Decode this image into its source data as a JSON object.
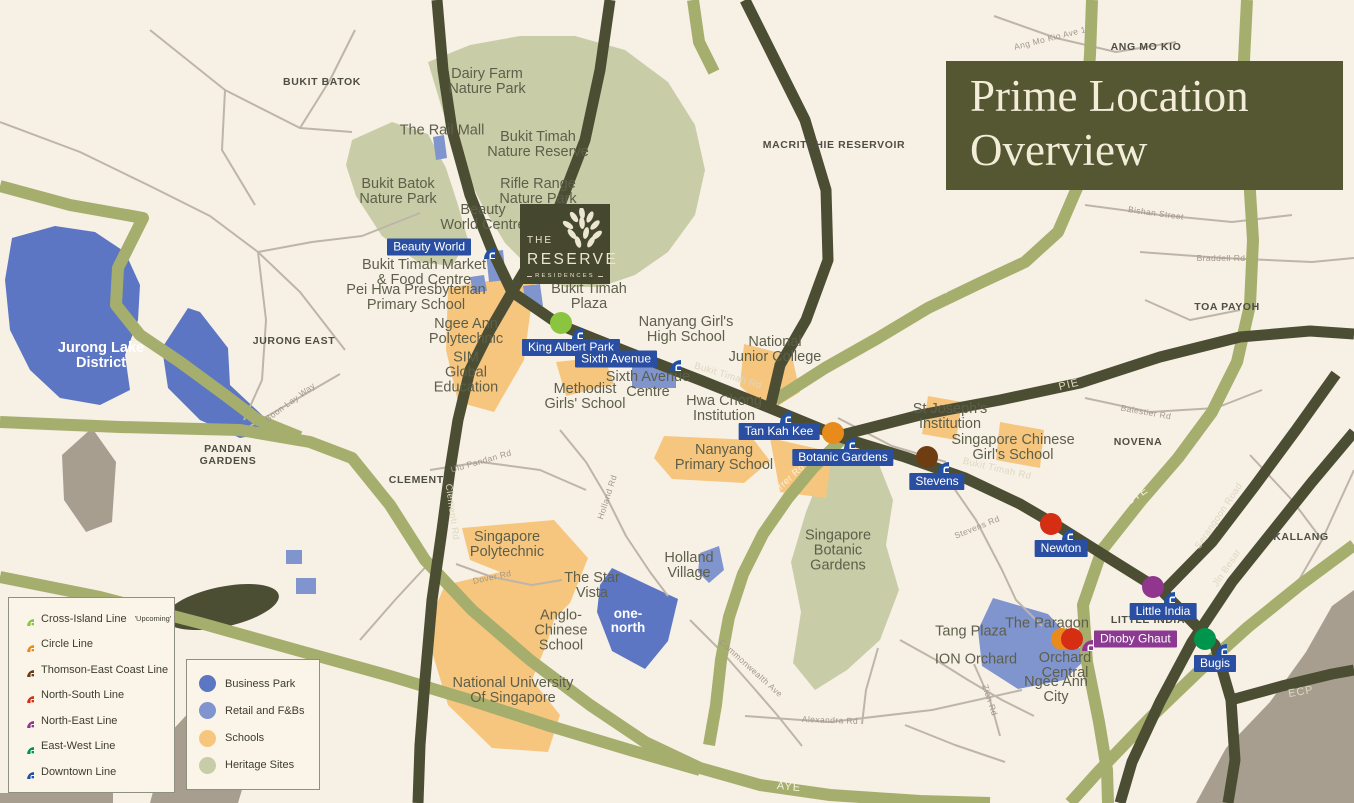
{
  "title": {
    "line1": "Prime Location",
    "line2": "Overview"
  },
  "logo": {
    "the": "THE",
    "name": "RESERVE",
    "sub": "RESIDENCES"
  },
  "legend_lines": [
    {
      "label": "Cross-Island Line",
      "note": "'Upcoming'",
      "color": "#8bc540"
    },
    {
      "label": "Circle Line",
      "color": "#e98a1d"
    },
    {
      "label": "Thomson-East Coast Line",
      "color": "#6e3d12"
    },
    {
      "label": "North-South Line",
      "color": "#d52e13"
    },
    {
      "label": "North-East Line",
      "color": "#91368e"
    },
    {
      "label": "East-West Line",
      "color": "#00954d"
    },
    {
      "label": "Downtown Line",
      "color": "#2150a5"
    }
  ],
  "legend_areas": [
    {
      "label": "Business Park",
      "color": "#5c76c3"
    },
    {
      "label": "Retail and F&Bs",
      "color": "#8094ce"
    },
    {
      "label": "Schools",
      "color": "#f7c67e"
    },
    {
      "label": "Heritage Sites",
      "color": "#c9cda7"
    }
  ],
  "stations": [
    {
      "name": "Beauty World"
    },
    {
      "name": "King Albert Park"
    },
    {
      "name": "Sixth Avenue"
    },
    {
      "name": "Tan Kah Kee"
    },
    {
      "name": "Botanic Gardens"
    },
    {
      "name": "Stevens"
    },
    {
      "name": "Newton"
    },
    {
      "name": "Little India"
    },
    {
      "name": "Dhoby Ghaut"
    },
    {
      "name": "Bugis"
    }
  ],
  "places": [
    {
      "t": "Dairy Farm\nNature Park"
    },
    {
      "t": "The Rail Mall"
    },
    {
      "t": "Bukit Timah\nNature Reserve"
    },
    {
      "t": "Bukit Batok\nNature Park"
    },
    {
      "t": "Rifle Range\nNature Park"
    },
    {
      "t": "Beauty\nWorld Centre"
    },
    {
      "t": "Bukit Timah Market\n& Food Centre"
    },
    {
      "t": "Pei Hwa Presbyterian\nPrimary School"
    },
    {
      "t": "Ngee Ann\nPolytechnic"
    },
    {
      "t": "SIM\nGlobal\nEducation"
    },
    {
      "t": "Bukit Timah\nPlaza"
    },
    {
      "t": "Nanyang Girl's\nHigh School"
    },
    {
      "t": "National\nJunior College"
    },
    {
      "t": "Sixth Avenue\nCentre"
    },
    {
      "t": "Methodist\nGirls' School"
    },
    {
      "t": "Hwa Chong\nInstitution"
    },
    {
      "t": "Nanyang\nPrimary School"
    },
    {
      "t": "St Joseph's\nInstitution"
    },
    {
      "t": "Singapore Chinese\nGirl's School"
    },
    {
      "t": "Singapore\nBotanic\nGardens"
    },
    {
      "t": "Holland\nVillage"
    },
    {
      "t": "The Star\nVista"
    },
    {
      "t": "Anglo-\nChinese\nSchool"
    },
    {
      "t": "one-\nnorth"
    },
    {
      "t": "Singapore\nPolytechnic"
    },
    {
      "t": "National University\nOf Singapore"
    },
    {
      "t": "Jurong Lake\nDistrict"
    },
    {
      "t": "Tang Plaza"
    },
    {
      "t": "The Paragon"
    },
    {
      "t": "ION Orchard"
    },
    {
      "t": "Orchard\nCentral"
    },
    {
      "t": "Ngee Ann\nCity"
    }
  ],
  "districts": [
    {
      "t": "BUKIT BATOK"
    },
    {
      "t": "MACRITCHIE RESERVOIR"
    },
    {
      "t": "ANG MO KIO"
    },
    {
      "t": "TOA PAYOH"
    },
    {
      "t": "JURONG EAST"
    },
    {
      "t": "PANDAN\nGARDENS"
    },
    {
      "t": "CLEMENTI"
    },
    {
      "t": "NOVENA"
    },
    {
      "t": "KALLANG"
    },
    {
      "t": "LITTLE INDIA"
    }
  ],
  "roads": [
    {
      "t": "Bukit Timah Rd"
    },
    {
      "t": "Bukit Timah Rd"
    },
    {
      "t": "Lornie Hwy"
    },
    {
      "t": "PIE"
    },
    {
      "t": "CTE"
    },
    {
      "t": "CTE"
    },
    {
      "t": "Serangoon Road"
    },
    {
      "t": "Jln Besar"
    },
    {
      "t": "ECP"
    },
    {
      "t": "AYE"
    },
    {
      "t": "Farrer Rd"
    },
    {
      "t": "Stevens Rd"
    },
    {
      "t": "Alexandra Rd"
    },
    {
      "t": "Commonwealth Ave"
    },
    {
      "t": "Zion Rd"
    },
    {
      "t": "Holland Rd"
    },
    {
      "t": "Ulu Pandan Rd"
    },
    {
      "t": "Clementi Rd"
    },
    {
      "t": "Dover Rd"
    },
    {
      "t": "Boon Lay Way"
    },
    {
      "t": "Balestier Rd"
    },
    {
      "t": "Bishan Street"
    },
    {
      "t": "Braddell Rd"
    },
    {
      "t": "Ang Mo Kio Ave 1"
    }
  ],
  "colors": {
    "background": "#f7f0e5",
    "heritage": "#c9cda7",
    "schools": "#f7c67e",
    "business_park": "#5c76c3",
    "retail": "#8094ce",
    "built_up": "#a89e90",
    "dark_road": "#4c4e33",
    "light_road": "#a6ae6e",
    "minor_road": "#beb5a8",
    "title_bg": "#545732",
    "station_pill_blue": "#2a4fa2",
    "station_pill_purple": "#8c3992"
  }
}
